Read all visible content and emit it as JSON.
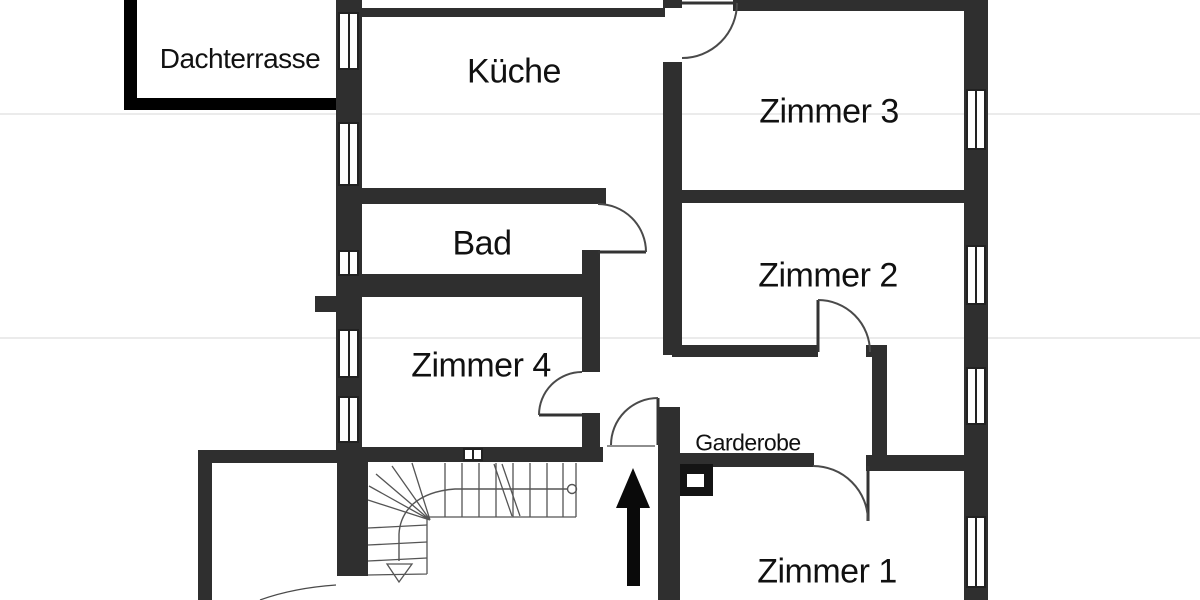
{
  "floorplan": {
    "type": "apartment-floor-plan",
    "rooms": [
      {
        "id": "dachterrasse",
        "label": "Dachterrasse"
      },
      {
        "id": "kueche",
        "label": "Küche"
      },
      {
        "id": "zimmer-3",
        "label": "Zimmer 3"
      },
      {
        "id": "bad",
        "label": "Bad"
      },
      {
        "id": "zimmer-2",
        "label": "Zimmer 2"
      },
      {
        "id": "zimmer-4",
        "label": "Zimmer 4"
      },
      {
        "id": "garderobe",
        "label": "Garderobe"
      },
      {
        "id": "zimmer-1",
        "label": "Zimmer 1"
      }
    ],
    "features": {
      "entrance_arrow": "up-arrow at apartment entrance door",
      "stairs": "quarter-turn winder staircase with down arrow and walk line",
      "window_count": 10,
      "door_count": 7
    },
    "colors": {
      "background": "#ffffff",
      "wall": "#2f2f2f",
      "terrace_wall": "#000000",
      "door_line": "#4a4a4a",
      "stair_line": "#555555",
      "text": "#111111"
    }
  }
}
